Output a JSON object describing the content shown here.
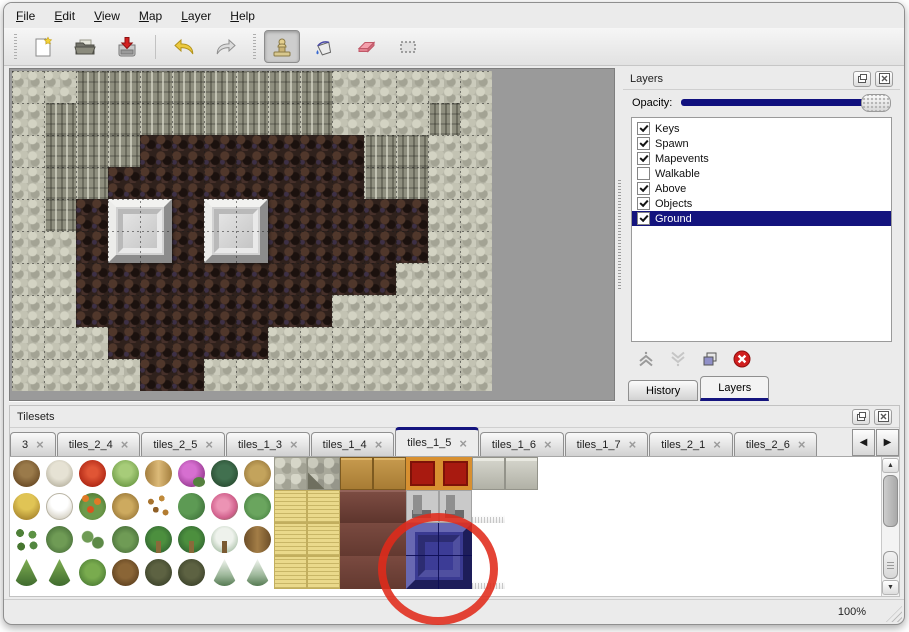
{
  "menu": {
    "items": [
      "File",
      "Edit",
      "View",
      "Map",
      "Layer",
      "Help"
    ]
  },
  "toolbar": {
    "groups": [
      {
        "buttons": [
          {
            "name": "new-map",
            "icon": "new-file-icon"
          },
          {
            "name": "open-map",
            "icon": "open-folder-icon"
          },
          {
            "name": "save-map",
            "icon": "save-icon"
          },
          {
            "separator": true
          },
          {
            "name": "undo",
            "icon": "undo-icon"
          },
          {
            "name": "redo",
            "icon": "redo-icon"
          }
        ]
      },
      {
        "buttons": [
          {
            "name": "stamp-tool",
            "icon": "stamp-icon",
            "active": true
          },
          {
            "name": "fill-tool",
            "icon": "fill-bucket-icon"
          },
          {
            "name": "eraser-tool",
            "icon": "eraser-icon"
          },
          {
            "name": "select-tool",
            "icon": "rect-select-icon"
          }
        ]
      }
    ]
  },
  "map": {
    "tile_size": 32,
    "columns": 15,
    "rows_count": 10,
    "legend": {
      "G": "stone-ground",
      "C": "cliff-wall",
      "F": "cave-floor"
    },
    "rows": [
      "GGCCCCCCCCGGGGG",
      "GCCCCCCCCCGGGCG",
      "GCCCFFFFFFFCCGG",
      "GCCFFFFFFFFCCGG",
      "GCFFFFFFFFFFFGG",
      "GGFFFFFFFFFFFGG",
      "GGFFFFFFFFFFGGG",
      "GGFFFFFFFFGGGGG",
      "GGGFFFFFGGGGGGG",
      "GGGGFFGGGGGGGGG"
    ],
    "pedestals": [
      {
        "col": 3,
        "row": 4
      },
      {
        "col": 6,
        "row": 4
      }
    ]
  },
  "layers_panel": {
    "title": "Layers",
    "opacity_label": "Opacity:",
    "opacity_percent": 100,
    "layers": [
      {
        "name": "Keys",
        "checked": true,
        "selected": false
      },
      {
        "name": "Spawn",
        "checked": true,
        "selected": false
      },
      {
        "name": "Mapevents",
        "checked": true,
        "selected": false
      },
      {
        "name": "Walkable",
        "checked": false,
        "selected": false
      },
      {
        "name": "Above",
        "checked": true,
        "selected": false
      },
      {
        "name": "Objects",
        "checked": true,
        "selected": false
      },
      {
        "name": "Ground",
        "checked": true,
        "selected": true
      }
    ],
    "actions": [
      {
        "name": "move-layer-up",
        "icon": "chevron-up-icon",
        "enabled": true
      },
      {
        "name": "move-layer-down",
        "icon": "chevron-down-icon",
        "enabled": false
      },
      {
        "name": "duplicate-layer",
        "icon": "duplicate-icon",
        "enabled": true
      },
      {
        "name": "delete-layer",
        "icon": "delete-icon",
        "enabled": true
      }
    ],
    "tabs": [
      {
        "label": "History",
        "active": false
      },
      {
        "label": "Layers",
        "active": true
      }
    ]
  },
  "tilesets_panel": {
    "title": "Tilesets",
    "tabs": [
      {
        "label": "3",
        "active": false
      },
      {
        "label": "tiles_2_4",
        "active": false
      },
      {
        "label": "tiles_2_5",
        "active": false
      },
      {
        "label": "tiles_1_3",
        "active": false
      },
      {
        "label": "tiles_1_4",
        "active": false
      },
      {
        "label": "tiles_1_5",
        "active": true
      },
      {
        "label": "tiles_1_6",
        "active": false
      },
      {
        "label": "tiles_1_7",
        "active": false
      },
      {
        "label": "tiles_2_1",
        "active": false
      },
      {
        "label": "tiles_2_6",
        "active": false
      }
    ],
    "palette": {
      "rows": [
        [
          "dead-tree",
          "pale-tree",
          "red-bloom",
          "green-stump",
          "tan-trunk",
          "purple-flowers",
          "dark-fern",
          "dry-sprig",
          "cobblestone",
          "cobblestone-dark",
          "wood-panel",
          "wood-panel",
          "red-carpet",
          "red-carpet",
          "stone-block",
          "stone-block"
        ],
        [
          "hay-mound",
          "snow-mound",
          "orange-flowers",
          "dry-bush",
          "leaf-scatter",
          "lily-pads",
          "pink-flowers",
          "lily-pad-large",
          "straw-mat",
          "straw-mat",
          "dark-table",
          "dark-table",
          "metal-frame",
          "metal-frame",
          "white-cloth",
          "white-plain"
        ],
        [
          "sprouts",
          "shrub",
          "shrub-pair",
          "shrub",
          "palm-top",
          "palm-top",
          "snow-palm",
          "palm-trunk",
          "straw-mat",
          "straw-mat",
          "brown-block",
          "brown-block",
          "blue-block",
          "blue-block",
          "white-plain",
          "white-plain"
        ],
        [
          "pine-tree",
          "pine-tree",
          "pine-round",
          "twisted-tree",
          "gnarled-tree",
          "gnarled-tree",
          "snow-pine",
          "snow-pine",
          "straw-mat",
          "straw-mat",
          "brown-block",
          "brown-block",
          "blue-block",
          "blue-block",
          "white-cloth",
          "white-plain"
        ]
      ],
      "selected_block": {
        "col": 12,
        "row": 2,
        "span": 2
      }
    }
  },
  "annotation": {
    "shape": "ellipse",
    "center_x": 438,
    "center_y": 569,
    "radius_x": 56,
    "radius_y": 52,
    "color": "#e02a1a",
    "stroke_width": 8
  },
  "statusbar": {
    "zoom_level": "100%"
  },
  "colors": {
    "selection_navy": "#14147e",
    "annotation_red": "#e02a1a",
    "canvas_gray": "#9a9a9a"
  }
}
